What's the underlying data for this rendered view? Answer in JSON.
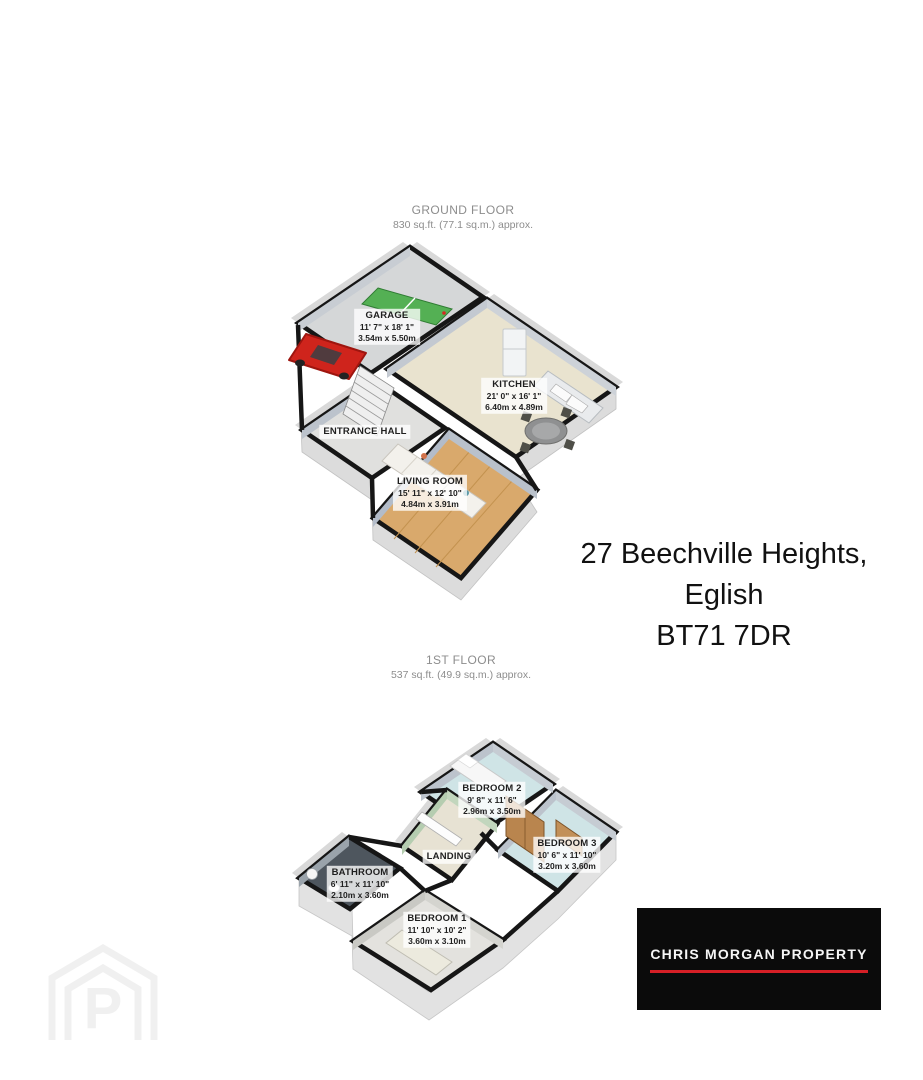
{
  "ground_floor": {
    "title": "GROUND FLOOR",
    "area": "830 sq.ft. (77.1 sq.m.) approx.",
    "rooms": [
      {
        "name": "GARAGE",
        "dims_ft": "11' 7\" x 18' 1\"",
        "dims_m": "3.54m x 5.50m"
      },
      {
        "name": "KITCHEN",
        "dims_ft": "21' 0\" x 16' 1\"",
        "dims_m": "6.40m x 4.89m"
      },
      {
        "name": "ENTRANCE HALL"
      },
      {
        "name": "LIVING ROOM",
        "dims_ft": "15' 11\" x 12' 10\"",
        "dims_m": "4.84m x 3.91m"
      }
    ]
  },
  "first_floor": {
    "title": "1ST FLOOR",
    "area": "537 sq.ft. (49.9 sq.m.) approx.",
    "rooms": [
      {
        "name": "BEDROOM 2",
        "dims_ft": "9' 8\" x 11' 6\"",
        "dims_m": "2.96m x 3.50m"
      },
      {
        "name": "BEDROOM 3",
        "dims_ft": "10' 6\" x 11' 10\"",
        "dims_m": "3.20m x 3.60m"
      },
      {
        "name": "LANDING"
      },
      {
        "name": "BATHROOM",
        "dims_ft": "6' 11\" x 11' 10\"",
        "dims_m": "2.10m x 3.60m"
      },
      {
        "name": "BEDROOM 1",
        "dims_ft": "11' 10\" x 10' 2\"",
        "dims_m": "3.60m x 3.10m"
      }
    ]
  },
  "address": {
    "line1": "27 Beechville Heights,",
    "line2": "Eglish",
    "line3": "BT71 7DR"
  },
  "branding": {
    "agency": "CHRIS MORGAN PROPERTY",
    "accent_color": "#d51f26",
    "background_color": "#0b0b0b"
  },
  "watermark": {
    "icon": "house-p-logo"
  }
}
